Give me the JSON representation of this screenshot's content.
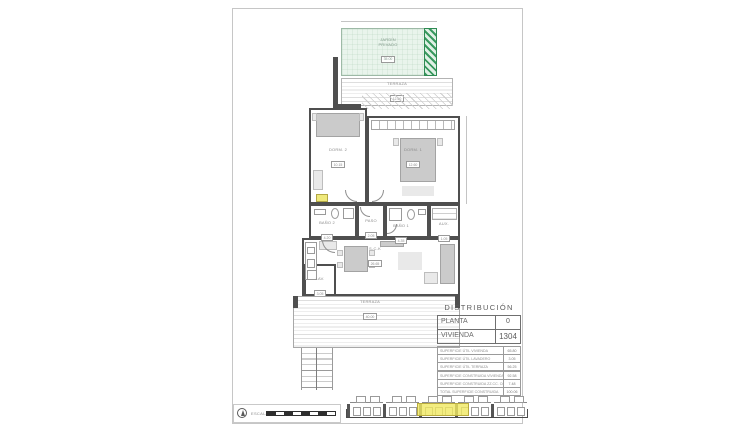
{
  "sheet": {
    "title_block": {
      "heading": "DISTRIBUCIÓN",
      "main_rows": [
        {
          "label": "PLANTA",
          "value": "0"
        },
        {
          "label": "VIVIENDA",
          "value": "1304"
        }
      ],
      "useful_areas": [
        {
          "label": "SUPERFICIE ÚTIL VIVIENDA",
          "value": "65.80"
        },
        {
          "label": "SUPERFICIE ÚTIL LAVADERO",
          "value": "3.05"
        },
        {
          "label": "SUPERFICIE ÚTIL TERRAZA",
          "value": "56.25"
        }
      ],
      "built_areas": [
        {
          "label": "SUPERFICIE CONSTRUIDA VIVIENDA",
          "value": "92.58"
        },
        {
          "label": "SUPERFICIE CONSTRUIDA ZZ.CC. COMUNES",
          "value": "7.48"
        },
        {
          "label": "TOTAL SUPERFICIE CONSTRUIDA",
          "value": "100.06"
        }
      ]
    },
    "plan": {
      "garden": {
        "name": "JARDÍN",
        "name2": "PRIVADO",
        "area": "35.00"
      },
      "terrace_top": {
        "name": "TERRAZA",
        "area": "12.60"
      },
      "rooms": {
        "dorm2": {
          "name": "DORM. 2",
          "area": "10.15"
        },
        "dorm1": {
          "name": "DORM. 1",
          "area": "12.60"
        },
        "bano2": {
          "name": "BAÑO 2",
          "area": "4.20"
        },
        "paso": {
          "name": "PASO",
          "area": "2.05"
        },
        "bano1": {
          "name": "BAÑO 1",
          "area": "4.35"
        },
        "aux": {
          "name": "AUX.",
          "area": "1.05"
        },
        "salon": {
          "name": "S-C-K",
          "area": "26.65"
        },
        "lavadero": {
          "name": "LAV.",
          "area": "3.05"
        }
      },
      "terrace_bottom": {
        "name": "TERRAZA",
        "area": "40.00"
      }
    },
    "footer": {
      "scale_label": "ESCALA",
      "elevation": {
        "units": 5,
        "highlighted_unit": "1304"
      }
    }
  }
}
